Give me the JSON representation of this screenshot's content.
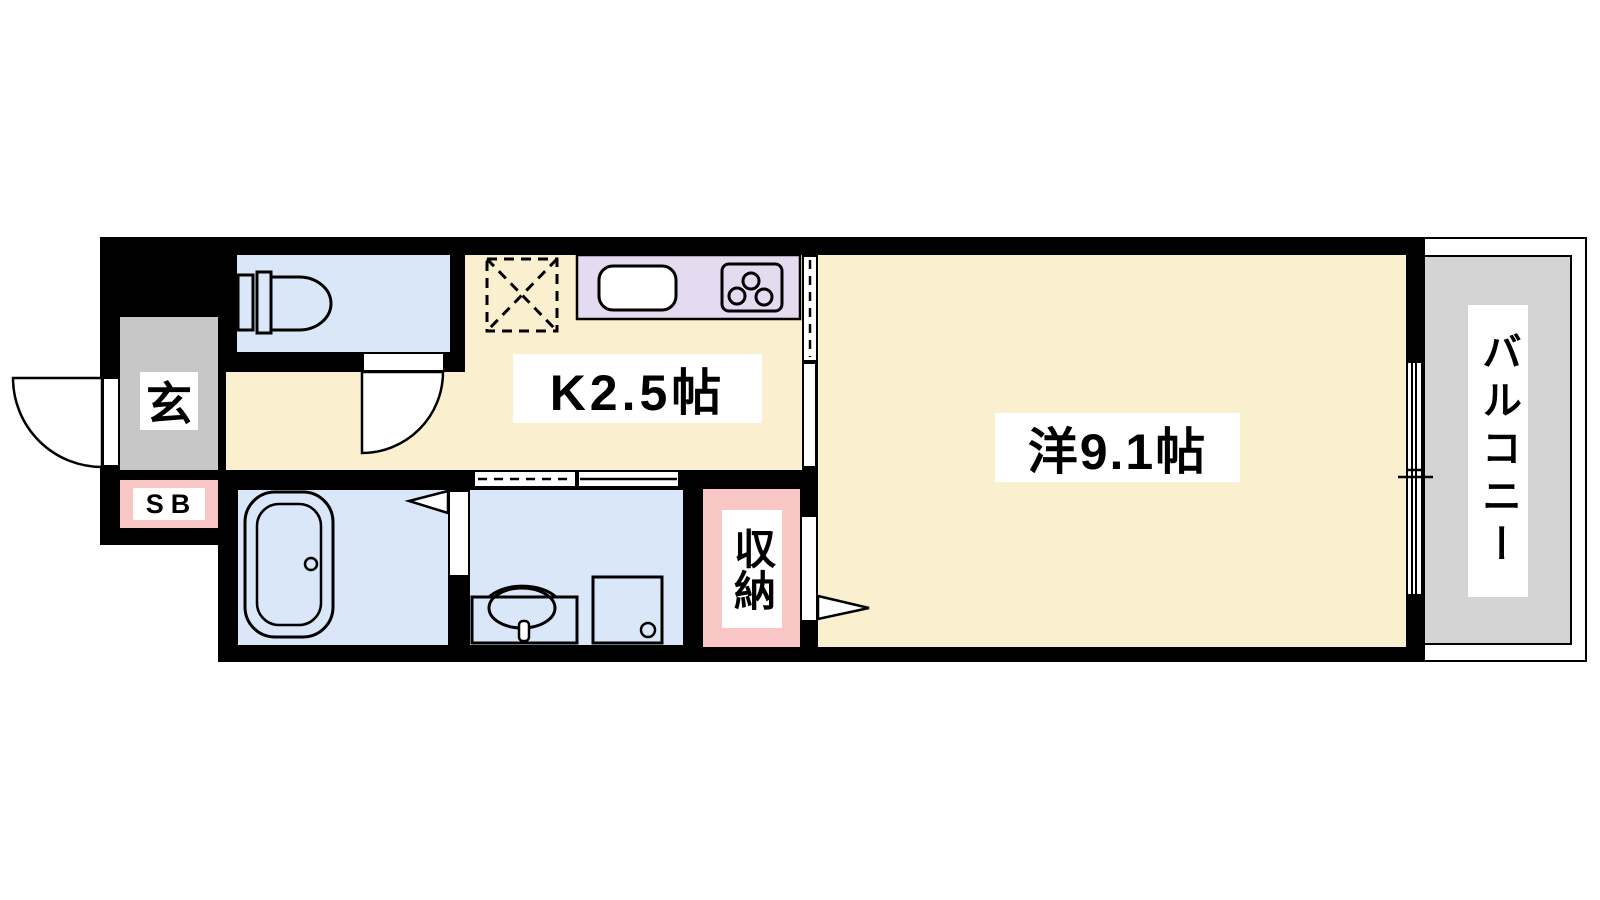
{
  "plan": {
    "type": "apartment-floor-plan",
    "labels": {
      "kitchen": "K2.5帖",
      "western_room": "洋9.1帖",
      "entrance": "玄",
      "shoe_box": "SB",
      "storage": "収納",
      "balcony": "バルコニー"
    },
    "rooms": [
      {
        "name": "kitchen",
        "label": "K2.5帖"
      },
      {
        "name": "western-room",
        "label": "洋9.1帖"
      },
      {
        "name": "entrance",
        "label": "玄"
      },
      {
        "name": "shoe-box",
        "label": "SB"
      },
      {
        "name": "storage",
        "label": "収納"
      },
      {
        "name": "balcony",
        "label": "バルコニー"
      },
      {
        "name": "toilet",
        "label": ""
      },
      {
        "name": "bathroom",
        "label": ""
      },
      {
        "name": "washroom",
        "label": ""
      }
    ],
    "icons": {
      "toilet": "toilet-icon",
      "bathtub": "bathtub-icon",
      "washbasin": "washbasin-icon",
      "washing_machine_space": "washing-machine-space-icon",
      "kitchen_sink": "kitchen-sink-icon",
      "stove": "gas-stove-icon",
      "refrigerator_space": "refrigerator-space-icon",
      "entrance_door": "swing-door-icon",
      "toilet_door": "swing-door-icon",
      "kitchen_sliding_door": "sliding-door-icon",
      "washroom_sliding_door": "sliding-door-icon",
      "bathroom_folding_door": "folding-door-icon",
      "storage_door": "storage-door-icon",
      "balcony_window": "sliding-window-icon"
    },
    "colors": {
      "wall_black": "#000000",
      "floor_cream": "#FAEFCF",
      "water_blue": "#D9E7F8",
      "counter_lavender": "#E5DBF1",
      "entrance_gray": "#C7C7C7",
      "balcony_gray": "#D4D4D4",
      "accent_pink": "#F9C6C6",
      "paper_white": "#FFFFFF"
    }
  }
}
